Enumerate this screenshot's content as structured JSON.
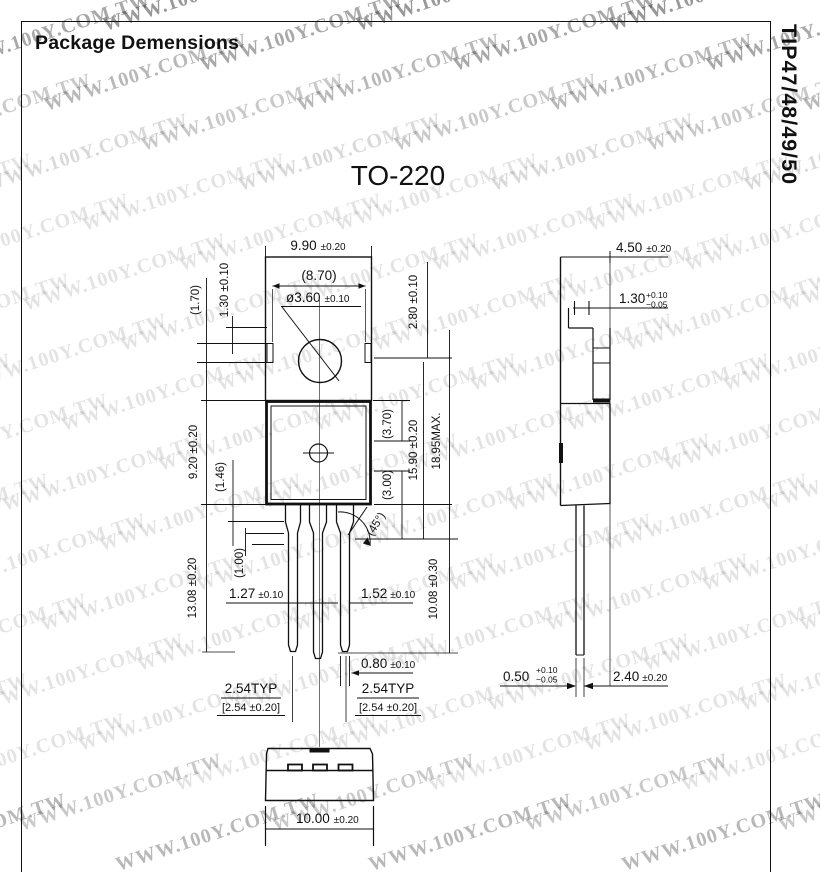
{
  "page": {
    "title": "Package Demensions",
    "part_number": "TIP47/48/49/50",
    "drawing_title": "TO-220"
  },
  "watermark": {
    "text": "WWW.100Y.COM.TW"
  },
  "dims": {
    "width": {
      "v": "9.90",
      "t": "±0.20"
    },
    "inner_width": "(8.70)",
    "hole": {
      "v": "ø3.60",
      "t": "±0.10"
    },
    "notch_h": "(1.70)",
    "notch_off": "1.30 ±0.10",
    "tab_top": "2.80 ±0.10",
    "body_h": "9.20 ±0.20",
    "shoulder_a": "(1.46)",
    "upper_r": "(3.70)",
    "mid_r": "15.90 ±0.20",
    "total_h": "18.95MAX.",
    "lower_r": "(3.00)",
    "angle": "(45°)",
    "lead_len": "13.08 ±0.20",
    "shoulder_b": "(1.00)",
    "lead_w1": {
      "v": "1.27",
      "t": "±0.10"
    },
    "lead_w2": {
      "v": "1.52",
      "t": "±0.10"
    },
    "lead_free": "10.08 ±0.30",
    "tip_w": {
      "v": "0.80",
      "t": "±0.10"
    },
    "pitch": "2.54TYP",
    "pitch_alt": "[2.54 ±0.20]",
    "bottom_w": {
      "v": "10.00",
      "t": "±0.20"
    },
    "depth": {
      "v": "4.50",
      "t": "±0.20"
    },
    "tab_t": {
      "v": "1.30",
      "tp": "+0.10",
      "tm": "−0.05"
    },
    "lead_t": {
      "v": "0.50",
      "tp": "+0.10",
      "tm": "−0.05"
    },
    "setback": {
      "v": "2.40",
      "t": "±0.20"
    }
  }
}
